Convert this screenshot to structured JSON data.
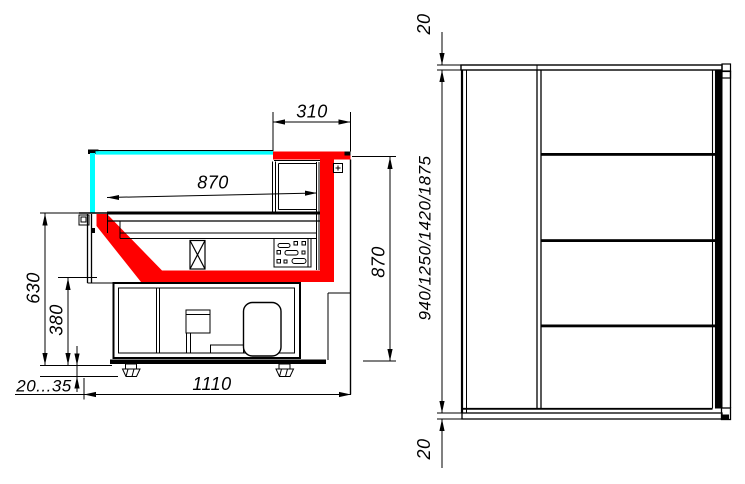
{
  "drawing": {
    "kind": "technical-drawing",
    "colors": {
      "line": "#000000",
      "glass": "#00ffff",
      "highlight": "#ff0000",
      "background": "#ffffff"
    }
  },
  "section": {
    "dim_canopy": "310",
    "dim_depth": "870",
    "dim_front_height": "630",
    "dim_lower_front_height": "380",
    "dim_feet_adjust": "20...35",
    "dim_base_depth": "1110",
    "dim_overall_height": "870"
  },
  "elevation": {
    "dim_top_thickness": "20",
    "dim_height_options": "940/1250/1420/1875",
    "dim_bottom_thickness": "20"
  }
}
